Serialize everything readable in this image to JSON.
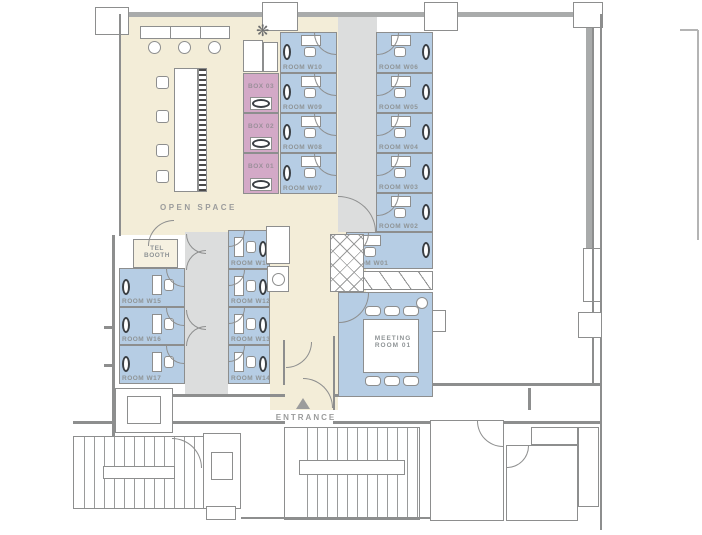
{
  "meta": {
    "drawing_type": "office floor plan"
  },
  "colors": {
    "open_space": "#f3edd8",
    "room_blue": "#b6cde4",
    "box_pink": "#d3a9c7",
    "corridor_gray": "#dcdddd",
    "wall_gray": "#8d8e8e",
    "label_gray": "#9b9c9c",
    "fixture_dark": "#3a3f44"
  },
  "areas": {
    "open_space": "OPEN SPACE",
    "tel_booth": "TEL BOOTH",
    "meeting_room": "MEETING ROOM 01",
    "entrance": "ENTRANCE"
  },
  "rooms": {
    "west_top": [
      "ROOM W10",
      "ROOM W09",
      "ROOM W08",
      "ROOM W07"
    ],
    "boxes": [
      "BOX 03",
      "BOX 02",
      "BOX 01"
    ],
    "east_top": [
      "ROOM W06",
      "ROOM W05",
      "ROOM W04",
      "ROOM W03",
      "ROOM W02",
      "ROOM W01"
    ],
    "mid": [
      "ROOM W11",
      "ROOM W12",
      "ROOM W13",
      "ROOM W14"
    ],
    "west_mid": [
      "ROOM W15",
      "ROOM W16",
      "ROOM W17"
    ]
  }
}
